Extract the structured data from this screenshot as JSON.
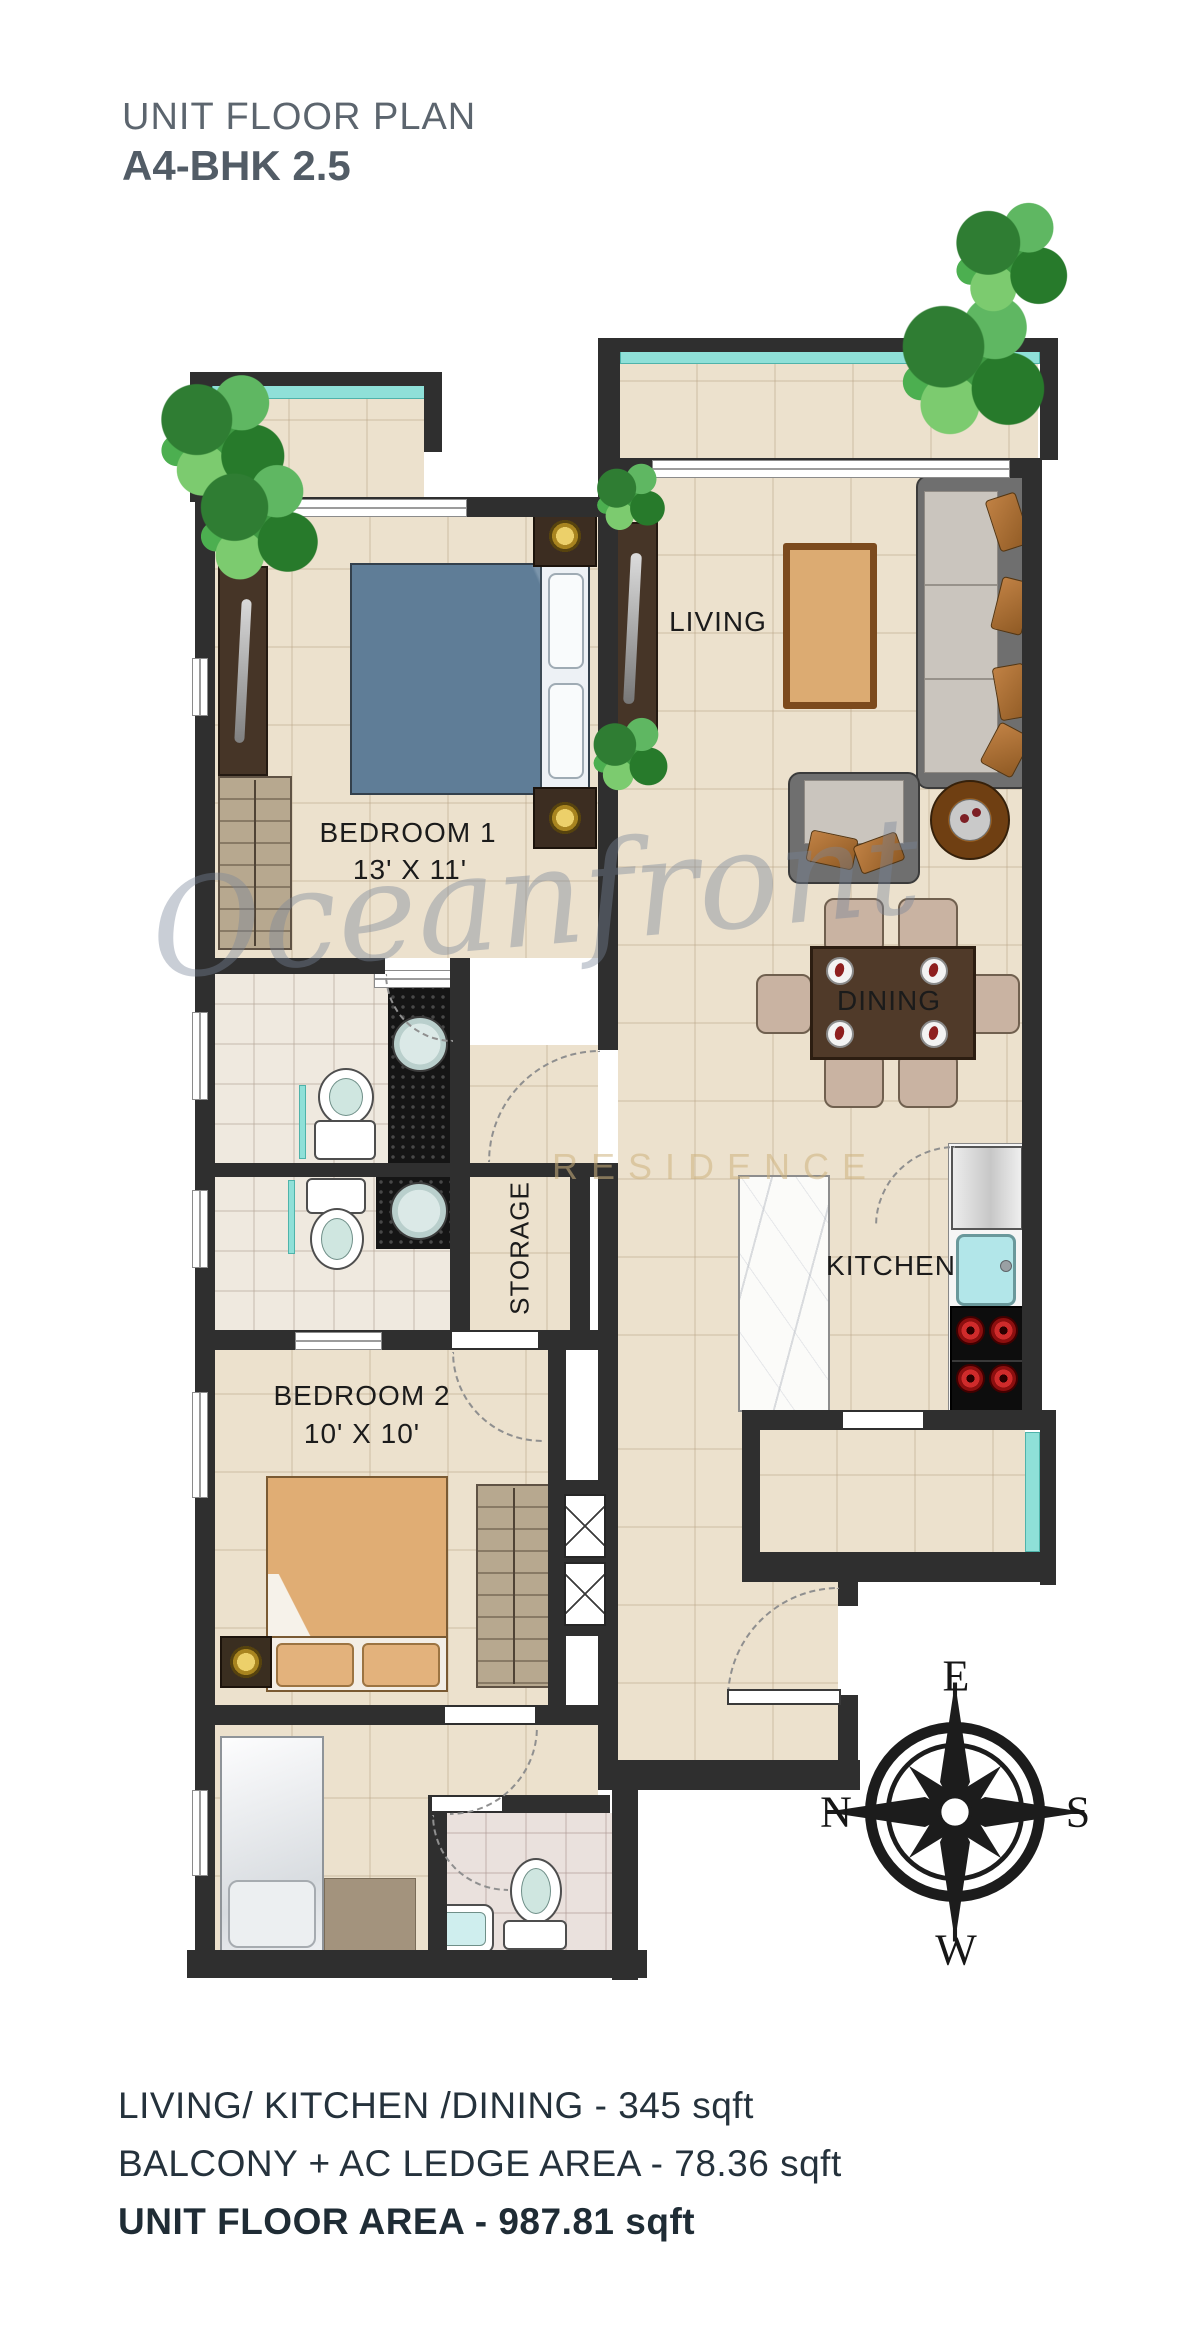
{
  "header": {
    "title": "UNIT FLOOR PLAN",
    "subtitle": "A4-BHK 2.5"
  },
  "rooms": {
    "bedroom1": {
      "label": "BEDROOM 1",
      "dims": "13' X 11'"
    },
    "bedroom2": {
      "label": "BEDROOM 2",
      "dims": "10' X 10'"
    },
    "living": {
      "label": "LIVING"
    },
    "dining": {
      "label": "DINING"
    },
    "kitchen": {
      "label": "KITCHEN"
    },
    "storage": {
      "label": "STORAGE"
    }
  },
  "compass": {
    "east": "E",
    "south": "S",
    "west": "W",
    "north": "N"
  },
  "watermark": {
    "script": "Oceanfront",
    "caps": "RESIDENCE"
  },
  "areas": [
    {
      "text": "LIVING/ KITCHEN /DINING - 345 sqft"
    },
    {
      "text": "BALCONY + AC LEDGE AREA - 78.36 sqft"
    },
    {
      "text": "UNIT FLOOR AREA - 987.81 sqft"
    }
  ],
  "colors": {
    "wall": "#2f2f2f",
    "floor": "#ece1cd",
    "teal": "#8fe0d8",
    "title": "#5c656e",
    "footer": "#25323c"
  }
}
